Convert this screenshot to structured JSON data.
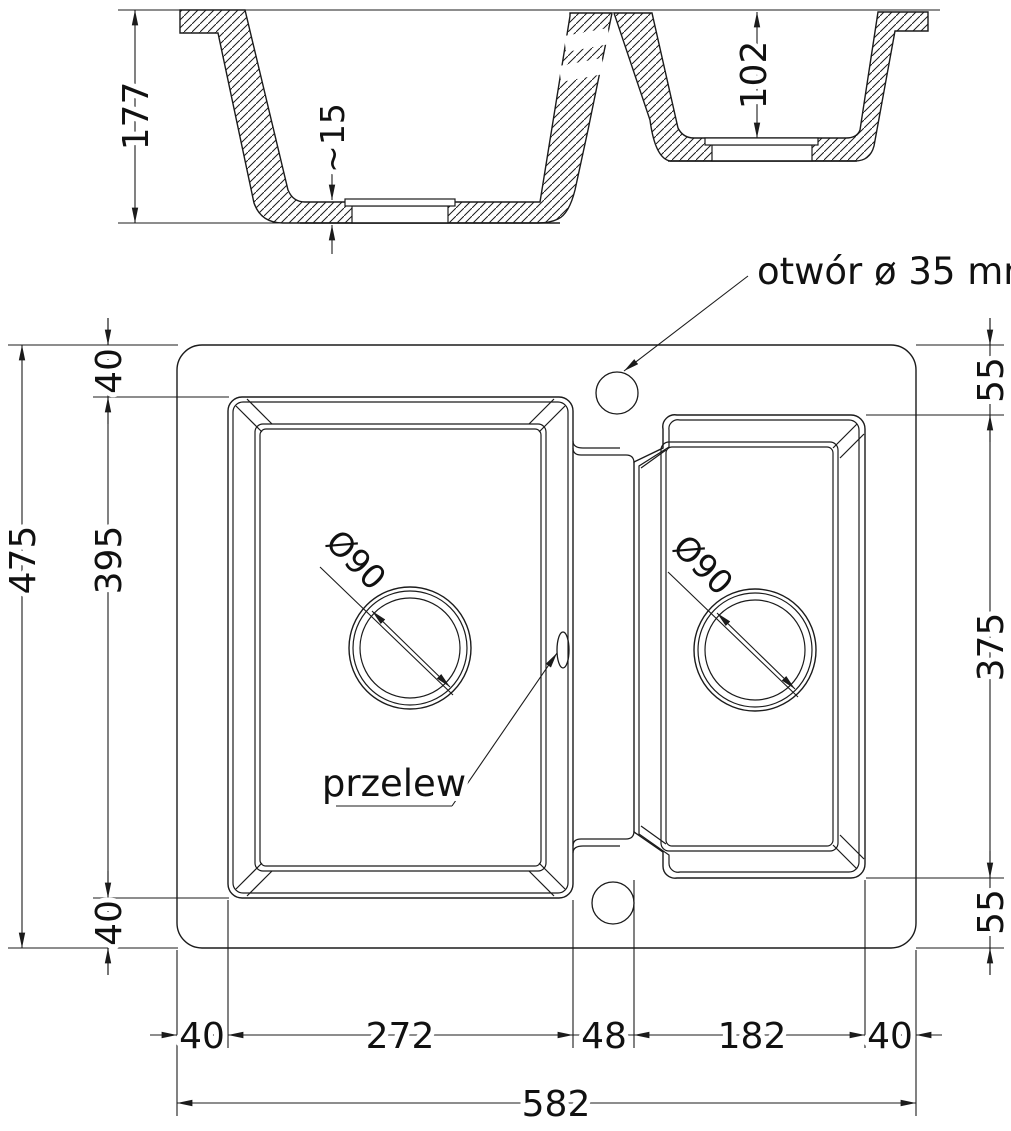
{
  "drawing_title": "double bowl sink technical drawing",
  "colors": {
    "line": "#1b1b1b",
    "background": "#ffffff"
  },
  "section_view": {
    "overall_depth": "177",
    "bottom_thickness": "~15",
    "small_bowl_depth": "102"
  },
  "plan_view": {
    "left_dims": {
      "overall_height": "475",
      "bowl_height": "395",
      "top_margin": "40",
      "bottom_margin": "40"
    },
    "right_dims": {
      "top_margin": "55",
      "bowl_height": "375",
      "bottom_margin": "55"
    },
    "bottom_dims": {
      "left_margin": "40",
      "left_bowl_width": "272",
      "divider_width": "48",
      "right_bowl_width": "182",
      "right_margin": "40",
      "overall_width": "582"
    },
    "drains": {
      "left": "Ø90",
      "right": "Ø90"
    },
    "annotations": {
      "faucet_hole": "otwór ø 35 mm",
      "overflow": "przelew"
    }
  }
}
